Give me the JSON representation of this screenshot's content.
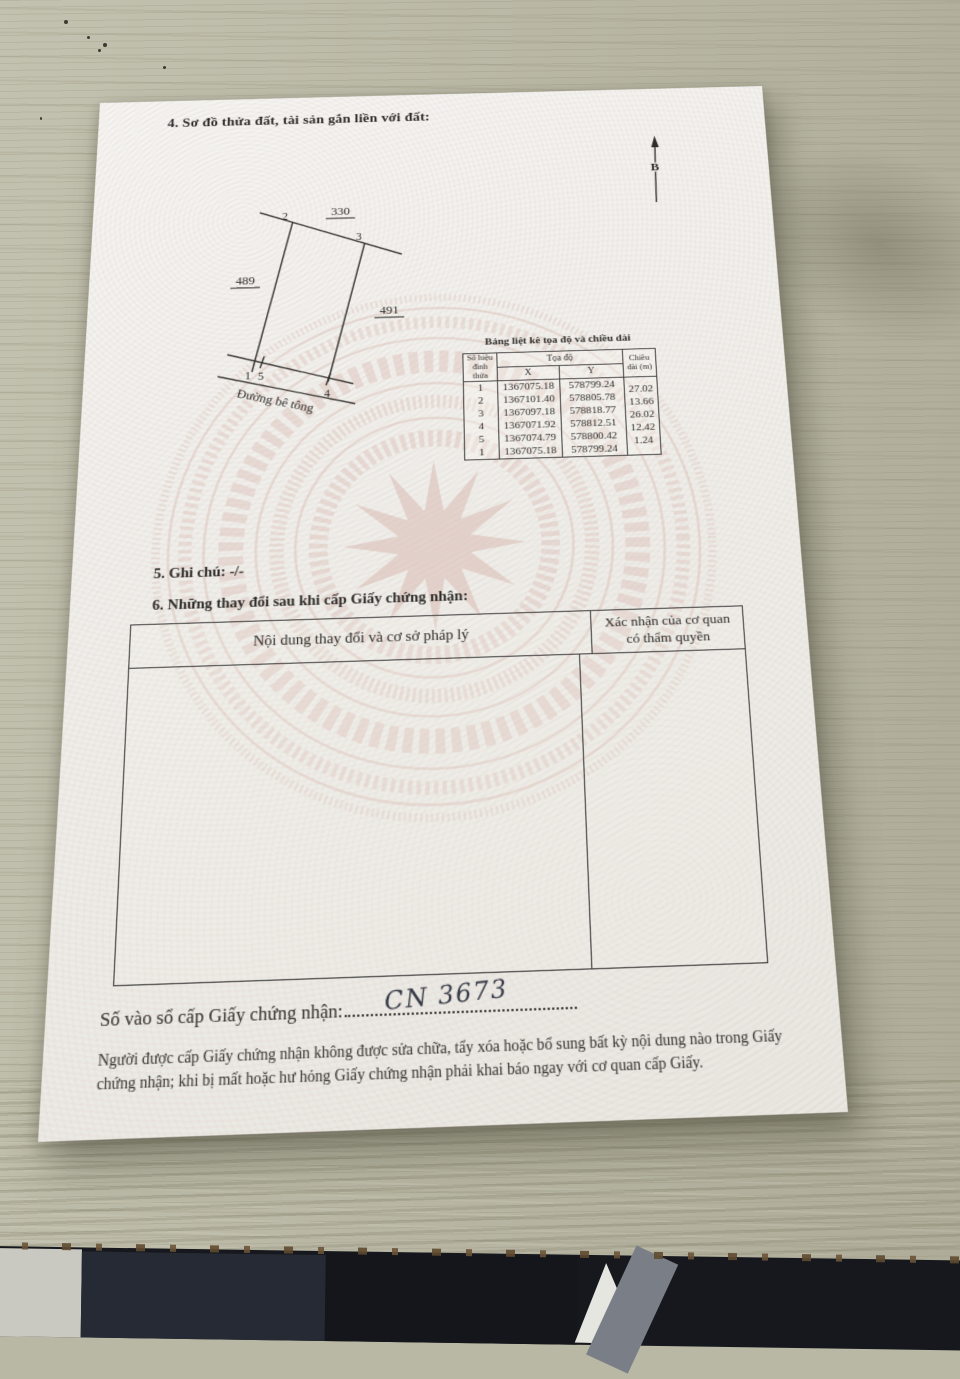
{
  "section4": {
    "title": "4. Sơ đồ thửa đất, tài sản gắn liền với đất:",
    "north_label": "B"
  },
  "diagram": {
    "label_top": "330",
    "label_left": "489",
    "label_right": "491",
    "v1": "1",
    "v2": "2",
    "v3": "3",
    "v4": "4",
    "v5": "5",
    "road": "Đường bê tông"
  },
  "coord_table": {
    "caption": "Bảng liệt kê tọa độ và chiều dài",
    "col_vertex": "Số hiệu đỉnh thửa",
    "col_coords": "Tọa độ",
    "col_x": "X",
    "col_y": "Y",
    "col_length": "Chiều dài (m)",
    "rows": [
      {
        "v": "1",
        "x": "1367075.18",
        "y": "578799.24"
      },
      {
        "v": "2",
        "x": "1367101.40",
        "y": "578805.78"
      },
      {
        "v": "3",
        "x": "1367097.18",
        "y": "578818.77"
      },
      {
        "v": "4",
        "x": "1367071.92",
        "y": "578812.51"
      },
      {
        "v": "5",
        "x": "1367074.79",
        "y": "578800.42"
      },
      {
        "v": "1",
        "x": "1367075.18",
        "y": "578799.24"
      }
    ],
    "lengths": [
      "27.02",
      "13.66",
      "26.02",
      "12.42",
      "1.24"
    ]
  },
  "section5": {
    "title": "5. Ghi chú: -/-"
  },
  "section6": {
    "title": "6. Những thay đổi sau khi cấp Giấy chứng nhận:",
    "col_content": "Nội dung thay đổi và cơ sở pháp lý",
    "col_confirm": "Xác nhận của cơ quan có thẩm quyền"
  },
  "footer": {
    "register_label": "Số vào sổ cấp Giấy chứng nhận:",
    "register_value": "CN 3673",
    "notice": "Người được cấp Giấy chứng nhận không được sửa chữa, tẩy xóa hoặc bổ sung bất kỳ nội dung nào trong Giấy chứng nhận; khi bị mất hoặc hư hỏng Giấy chứng nhận phải khai báo ngay với cơ quan cấp Giấy."
  }
}
